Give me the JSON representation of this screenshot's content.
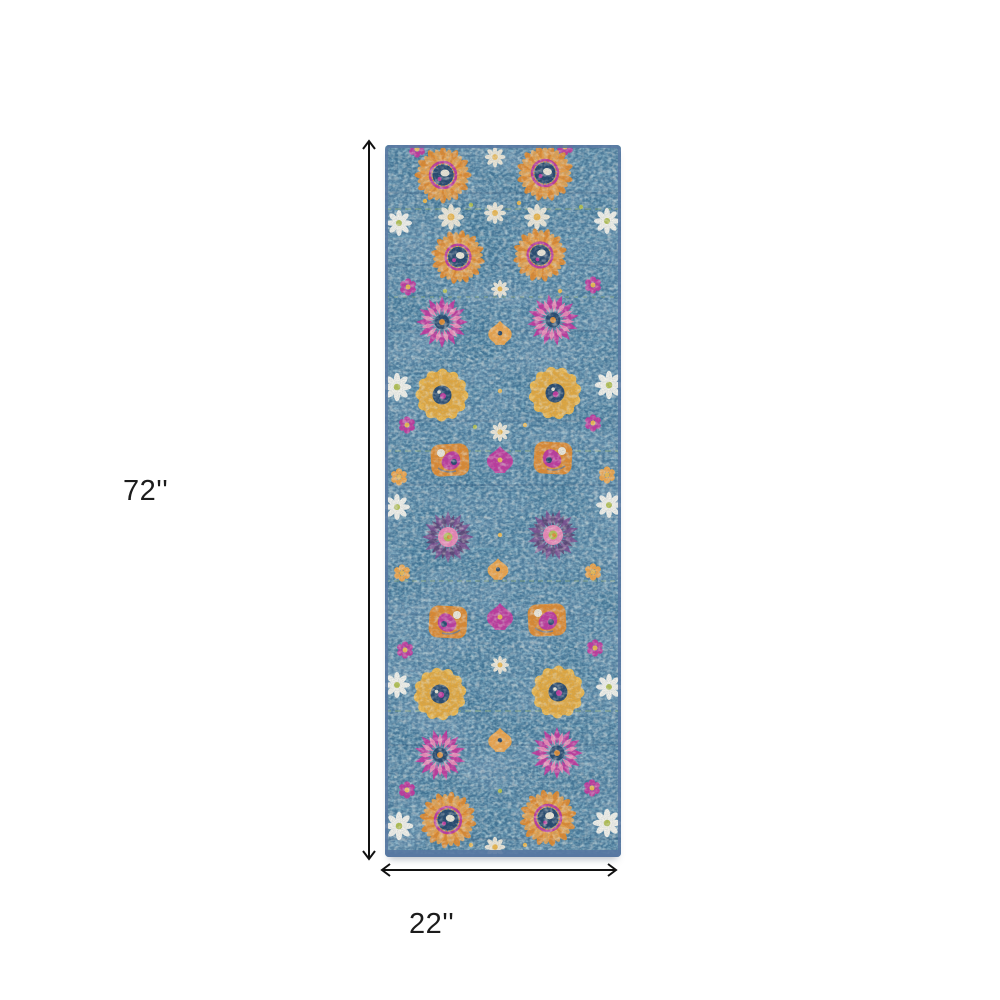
{
  "page": {
    "background": "#ffffff"
  },
  "dimension_annotations": {
    "height": {
      "label": "72''"
    },
    "width": {
      "label": "22''"
    },
    "arrow_color": "#111111",
    "label_color": "#1c1c1c"
  },
  "rug_image": {
    "name": "blue-floral-runner-rug",
    "colors": {
      "base": "#3e7293",
      "navy": "#24466b",
      "teal": "#73b2c6",
      "orange": "#e2892b",
      "orange2": "#f2a445",
      "golden": "#f2b848",
      "golden2": "#e8a838",
      "magenta": "#c2369b",
      "pink": "#f085b5",
      "purple": "#7a4f8e",
      "purple2": "#5e3a6e",
      "cream": "#f2ead8",
      "white": "#f8f5ec",
      "olive": "#b6c24d",
      "binding": "#5878a2"
    }
  }
}
